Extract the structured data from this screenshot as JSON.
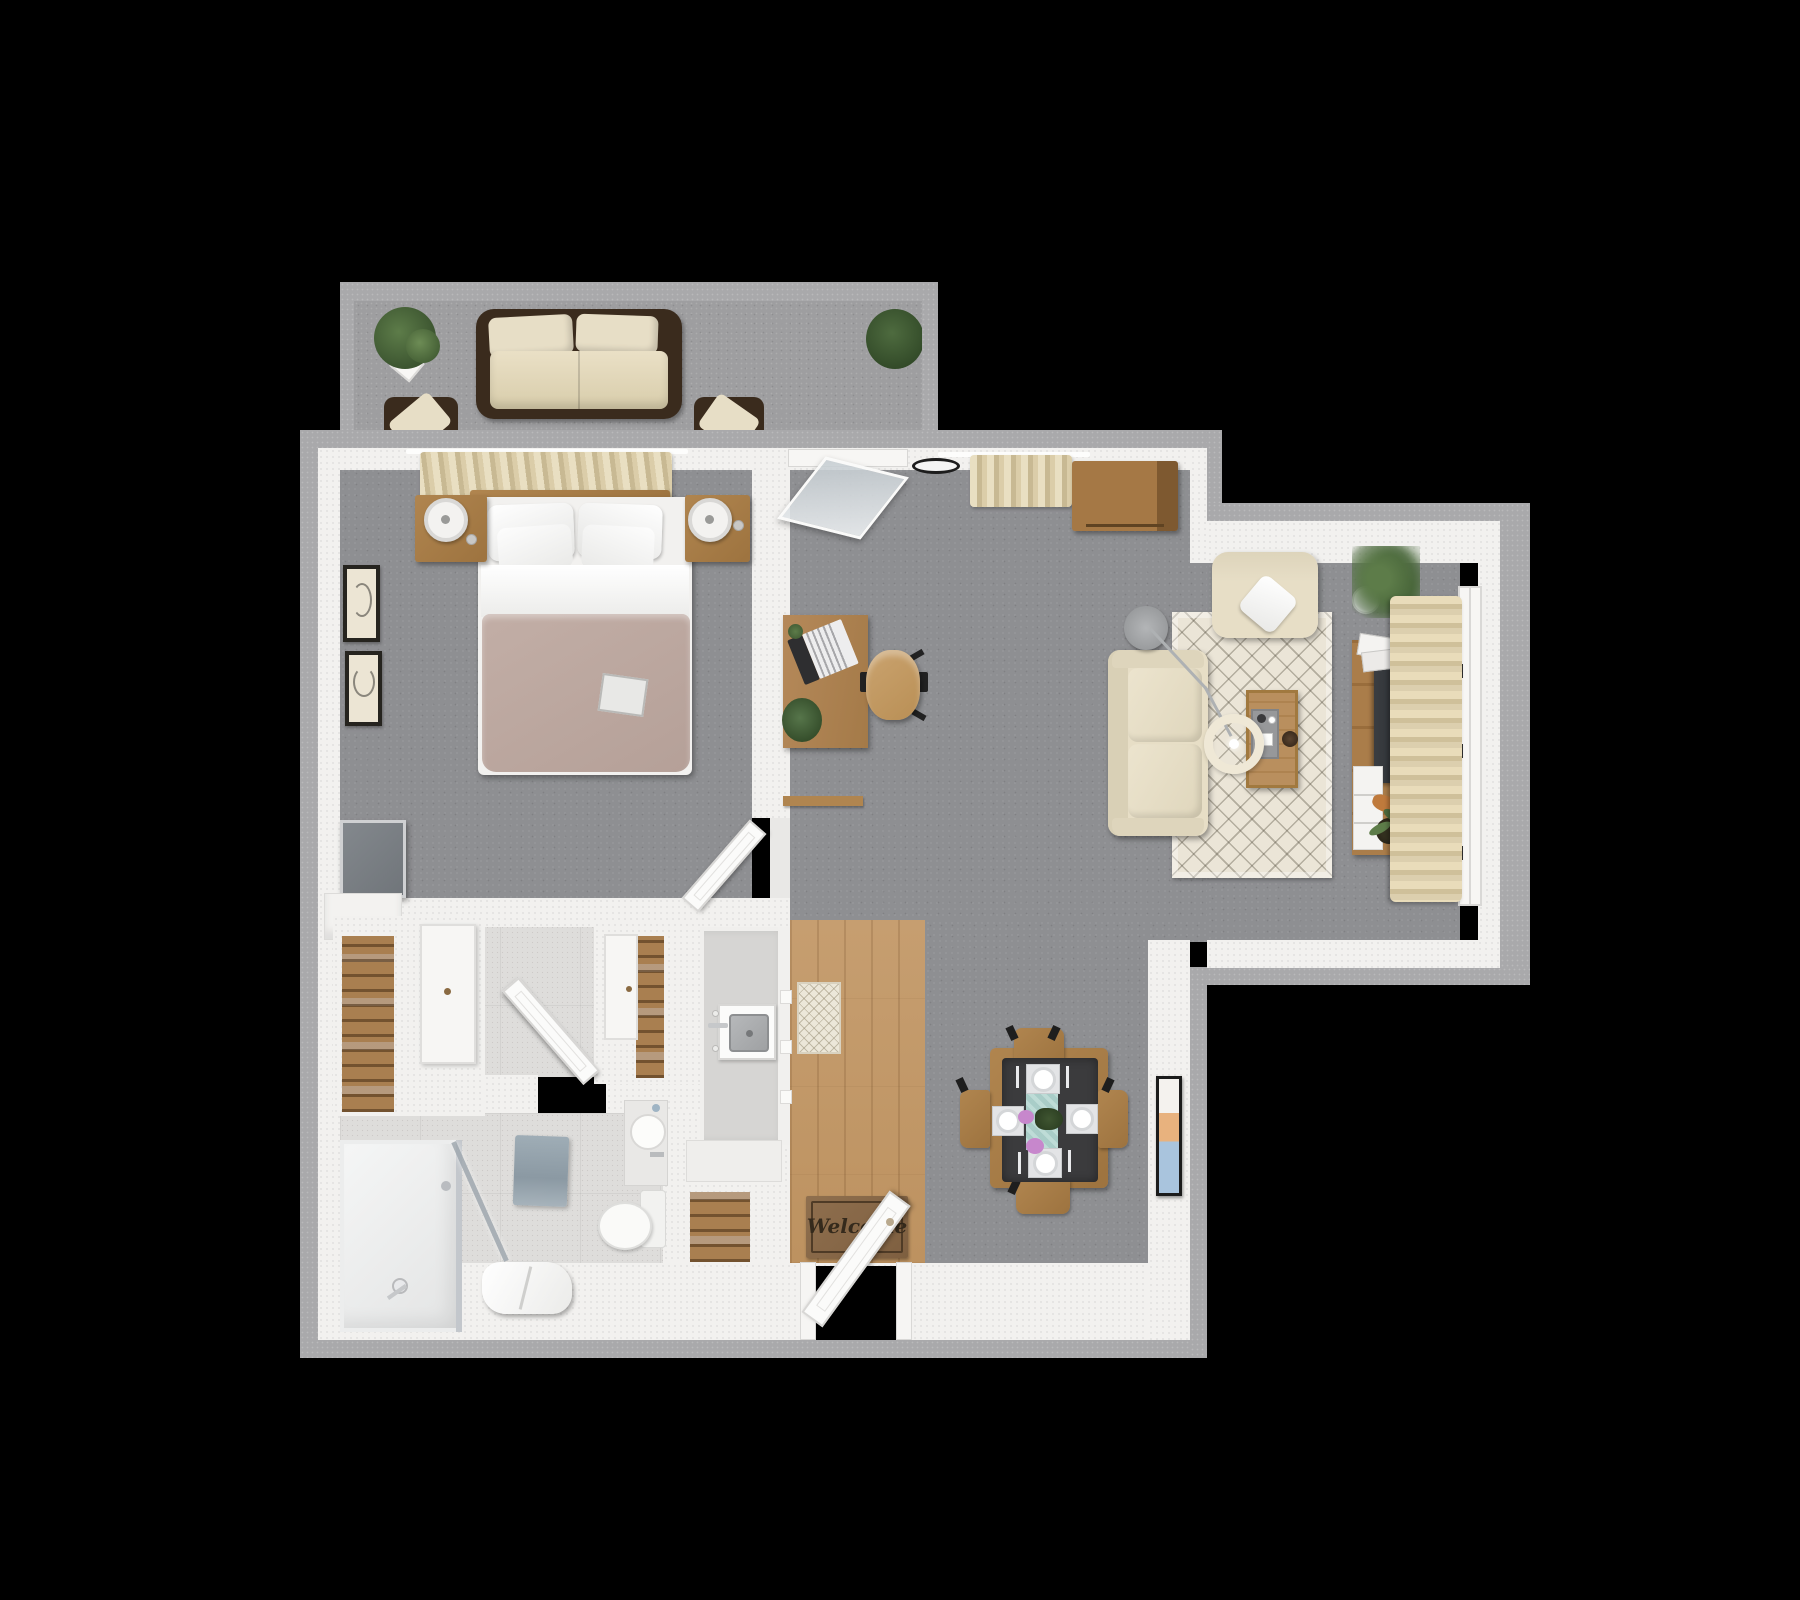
{
  "scene": {
    "type": "3d-floorplan-top-down-render",
    "description": "One-bedroom apartment 3D floor plan on black background",
    "welcome_mat_text": "Welcome"
  },
  "palette": {
    "background": "#000000",
    "outer_wall": "#a9a9ab",
    "inner_wall": "#f2f1ef",
    "floor_main": "#8e8f92",
    "floor_balcony": "#9e9ea0",
    "floor_tile": "#dedddb",
    "floor_wood": "#c69e70",
    "wood_furniture": "#b0854f",
    "dark_wicker": "#3a2b1d",
    "cushion_cream": "#e7dec6",
    "bed_blanket": "#c2aea6",
    "rug_cream": "#ebe5d7",
    "curtain_cream": "#ddd0ae",
    "tv_dark": "#2c2f33",
    "teal_runner": "#a9cdc8",
    "flower_purple": "#c787cc",
    "towel_blue": "#9fadb6",
    "plant_green": "#4e6b3f",
    "chair_tan": "#caa36f",
    "table_dark": "#3b3b3d"
  },
  "inventory": {
    "balcony": [
      "potted-plant",
      "wicker-sofa",
      "wicker-chair",
      "wicker-chair",
      "potted-plant"
    ],
    "bedroom": [
      "window-curtain",
      "double-bed",
      "nightstand-lamp",
      "nightstand-lamp",
      "wall-art",
      "wall-art",
      "wall-tv",
      "dresser",
      "closet-shelves",
      "closet-door"
    ],
    "bathroom": [
      "walk-in-shower",
      "shower-head",
      "glass-door",
      "towel-rack",
      "towel-bench",
      "toilet",
      "vanity-sink",
      "bath-door"
    ],
    "kitchen_entry": [
      "kitchen-counter",
      "kitchen-sink",
      "kitchen-rug",
      "welcome-mat",
      "front-door",
      "entry-closet-shelves"
    ],
    "dining": [
      "dining-table",
      "dining-chair",
      "dining-chair",
      "dining-chair",
      "dining-chair",
      "place-setting",
      "table-runner",
      "flower-centerpiece",
      "wall-art"
    ],
    "living": [
      "open-tilt-window",
      "wall-clock",
      "window-curtain",
      "storage-cabinet",
      "desk",
      "laptop",
      "office-chair",
      "desk-plant",
      "armchair",
      "throw-pillow",
      "sofa",
      "area-rug",
      "coffee-table",
      "serving-tray",
      "arc-floor-lamp",
      "tv-console",
      "television",
      "magazines",
      "drawer-unit",
      "potted-plant",
      "window-curtain",
      "casement-window"
    ]
  }
}
